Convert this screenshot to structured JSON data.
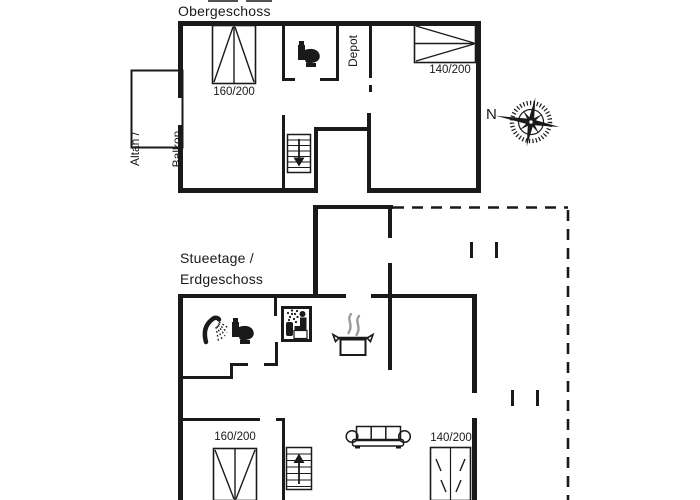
{
  "page": {
    "background": "#ffffff",
    "ink_color": "#1a1a1a",
    "steam_color": "#9b9b9b"
  },
  "upper_floor": {
    "title": "Obergeschoss",
    "balcony_label": [
      "Altan /",
      "Balkon"
    ],
    "depot_label": "Depot",
    "bed_left_size": "160/200",
    "bed_right_size": "140/200"
  },
  "ground_floor": {
    "title": [
      "Stueetage /",
      "Erdgeschoss"
    ],
    "bed_left_size": "160/200",
    "bed_right_size": "140/200"
  },
  "compass": {
    "north_label": "N"
  },
  "icons": [
    "toilet-icon",
    "shower-icon",
    "sauna-icon",
    "cooking-pot-icon",
    "sofa-icon",
    "stairs-down-icon",
    "stairs-up-icon",
    "compass-rose-icon"
  ]
}
